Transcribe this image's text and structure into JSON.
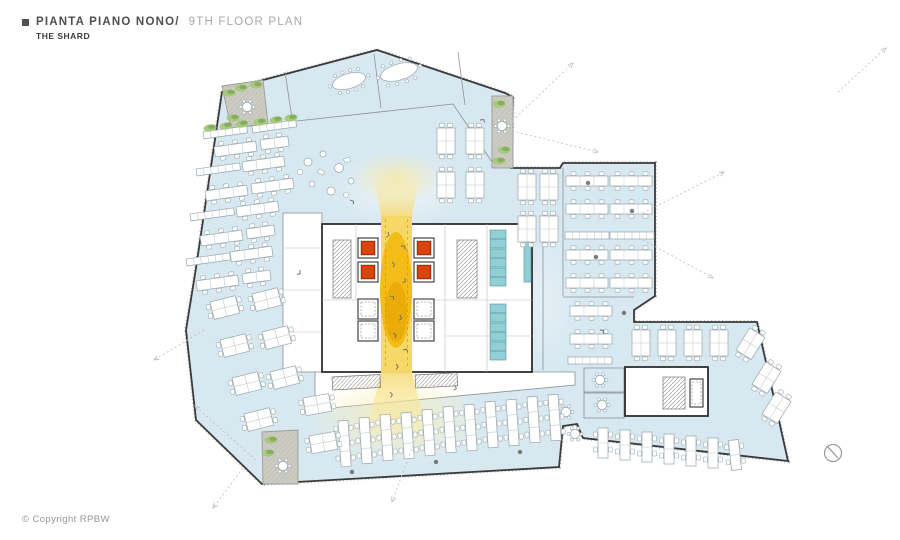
{
  "header": {
    "bullet": "■",
    "title_primary": "PIANTA PIANO NONO/",
    "title_secondary": "9TH FLOOR PLAN",
    "subtitle": "THE SHARD"
  },
  "footer": {
    "copyright": "© Copyright RPBW"
  },
  "colors": {
    "office": "#d7e8f0",
    "wall": "#3a3a3a",
    "wall_light": "#8a9296",
    "atrium": "#f3b70a",
    "lift": "#d9440f",
    "teal": "#8fd0d6",
    "teal_stroke": "#4e939b",
    "terrace": "#cbcbc3",
    "plant": "#a8c87e",
    "plant_dark": "#7ba654",
    "desk": "#ffffff",
    "desk_stroke": "#97a6ad",
    "arrow": "#c2c2c2",
    "text_dark": "#4f4f4f",
    "text_mid": "#a8a8a8",
    "text_subtitle": "#3c3c3c",
    "copyright": "#969696",
    "compass": "#8f8f8f",
    "hatch": "#8b8b8b"
  }
}
